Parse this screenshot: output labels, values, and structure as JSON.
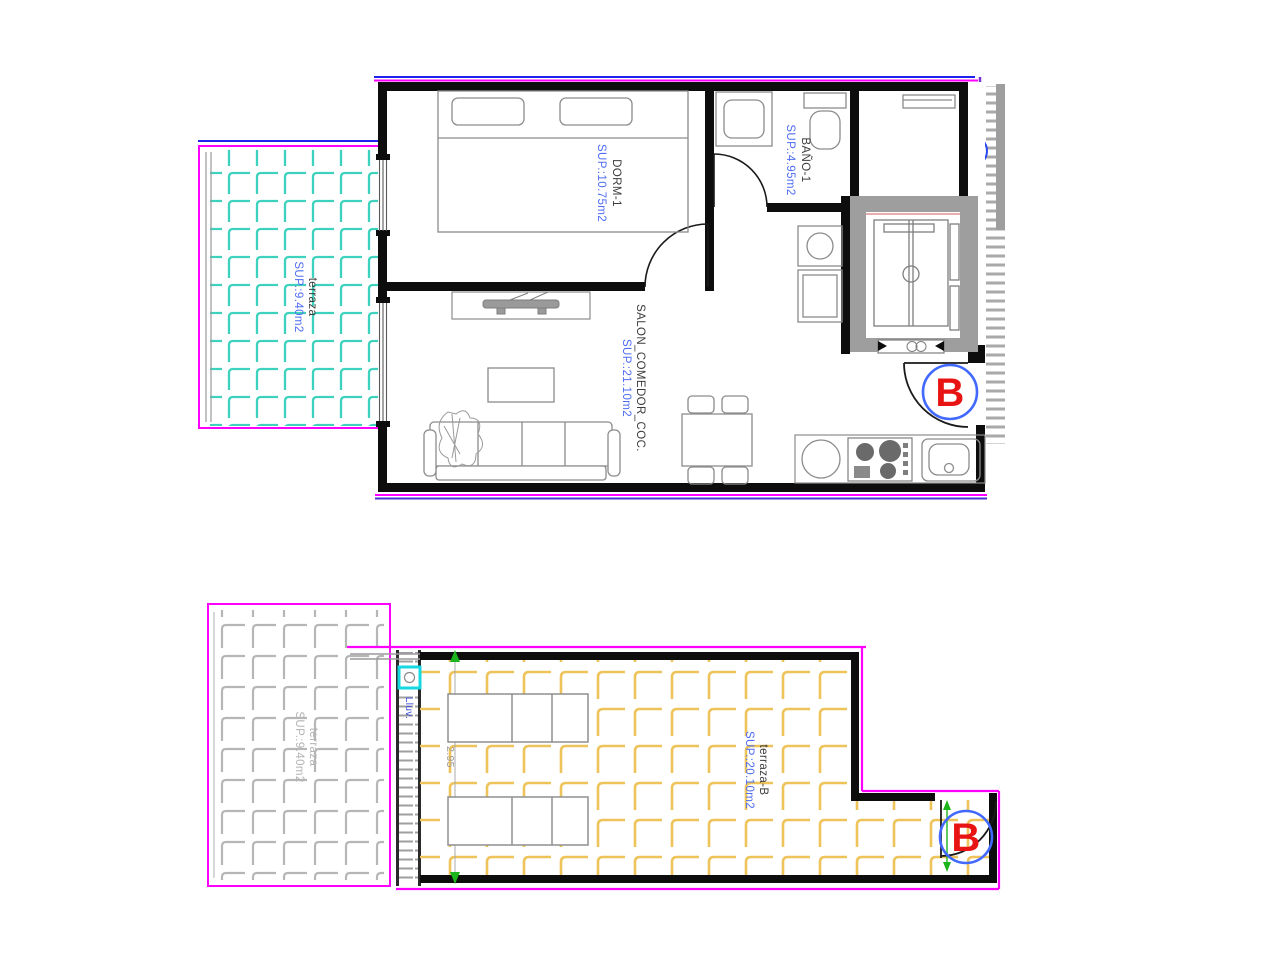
{
  "plan_top": {
    "rooms": {
      "dorm": {
        "name": "DORM-1",
        "area": "SUP.:10.75m2"
      },
      "bano": {
        "name": "BAÑO-1",
        "area": "SUP.:4.95m2"
      },
      "salon": {
        "name": "SALON_COMEDOR_COC.",
        "area": "SUP.:21.10m2"
      }
    },
    "terraza": {
      "name": "terraza",
      "area": "SUP.:9.40m2"
    },
    "unit_letter": "B"
  },
  "plan_bottom": {
    "terraza_b": {
      "name": "terraza-B",
      "area": "SUP.:20.10m2"
    },
    "terraza_gray": {
      "name": "terraza",
      "area": "SUP.:9.40m2"
    },
    "drain_label": "Lluv.",
    "dimension": "2.95",
    "unit_letter": "B"
  },
  "colors": {
    "wall_black": "#0d0d0d",
    "outline_magenta": "#ff00ff",
    "outline_blue": "#2222ee",
    "outline_violet": "#7b2fd6",
    "tile_teal": "#3ed2be",
    "tile_yellow": "#eec35a",
    "tile_gray": "#b6b6b6",
    "label_blue": "#4f6df2",
    "unit_red": "#e81414",
    "unit_circle_blue": "#4169ff",
    "dim_green": "#1db51d",
    "drain_cyan": "#16d8e0"
  }
}
